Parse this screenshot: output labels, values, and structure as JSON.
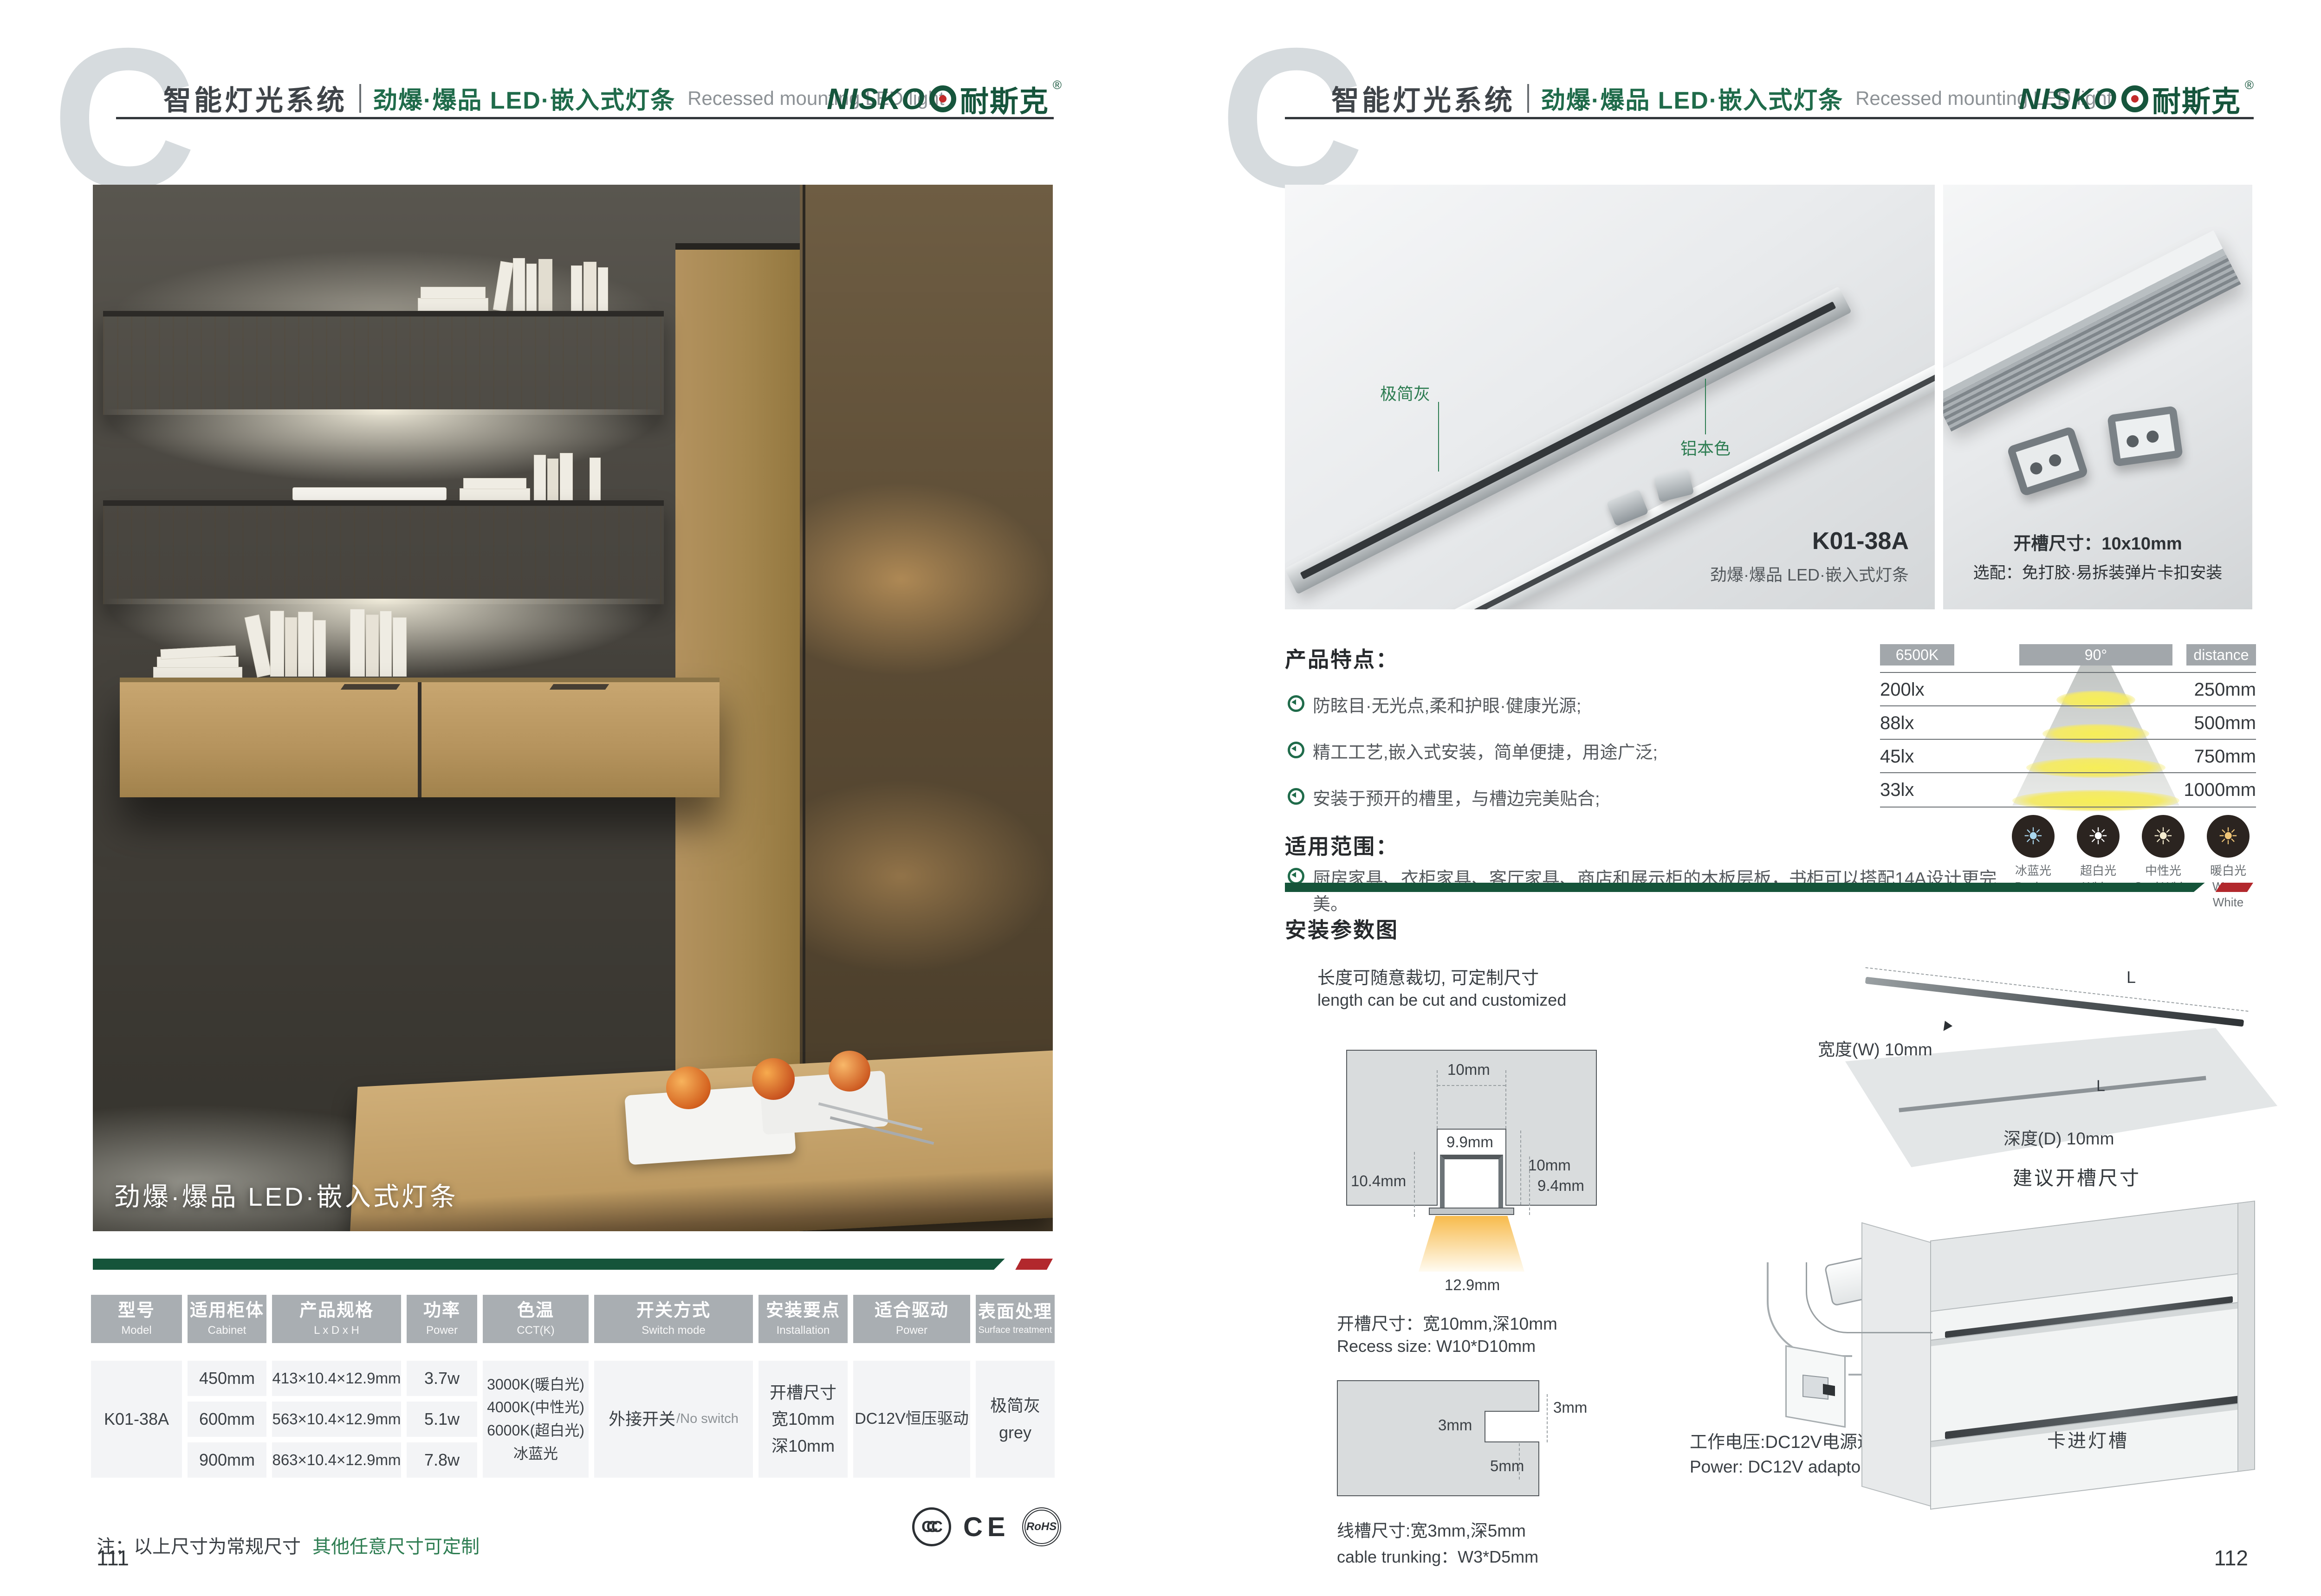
{
  "header": {
    "watermark": "C",
    "title_cn": "智能灯光系统",
    "subtitle_cn": "劲爆·爆品 LED·嵌入式灯条",
    "subtitle_en": "Recessed mounting LED light",
    "brand_en": "NISKO",
    "brand_cn": "耐斯克",
    "registered": "®"
  },
  "left_page": {
    "photo_caption": "劲爆·爆品 LED·嵌入式灯条",
    "table": {
      "columns": [
        {
          "cn": "型号",
          "en": "Model"
        },
        {
          "cn": "适用柜体",
          "en": "Cabinet"
        },
        {
          "cn": "产品规格",
          "en": "L x D x H"
        },
        {
          "cn": "功率",
          "en": "Power"
        },
        {
          "cn": "色温",
          "en": "CCT(K)"
        },
        {
          "cn": "开关方式",
          "en": "Switch mode"
        },
        {
          "cn": "安装要点",
          "en": "Installation"
        },
        {
          "cn": "适合驱动",
          "en": "Power"
        },
        {
          "cn": "表面处理",
          "en": "Surface treatment"
        }
      ],
      "model": "K01-38A",
      "rows": [
        {
          "cabinet": "450mm",
          "spec": "413×10.4×12.9mm",
          "power": "3.7w"
        },
        {
          "cabinet": "600mm",
          "spec": "563×10.4×12.9mm",
          "power": "5.1w"
        },
        {
          "cabinet": "900mm",
          "spec": "863×10.4×12.9mm",
          "power": "7.8w"
        }
      ],
      "cct_lines": [
        "3000K(暖白光)",
        "4000K(中性光)",
        "6000K(超白光)",
        "冰蓝光"
      ],
      "switch_cn": "外接开关",
      "switch_en": "/No switch",
      "install_lines": [
        "开槽尺寸",
        "宽10mm",
        "深10mm"
      ],
      "driver": "DC12V恒压驱动",
      "surface_cn": "极简灰",
      "surface_en": "grey"
    },
    "note_black": "注：以上尺寸为常规尺寸",
    "note_green": "其他任意尺寸可定制",
    "certs": [
      "CCC",
      "CE",
      "RoHS"
    ],
    "page_number": "111"
  },
  "right_page": {
    "photo_main": {
      "label_gray": "极简灰",
      "label_aluminum": "铝本色",
      "model": "K01-38A",
      "model_sub": "劲爆·爆品 LED·嵌入式灯条"
    },
    "photo_detail": {
      "line1": "开槽尺寸：10x10mm",
      "line2": "选配：免打胶·易拆装弹片卡扣安装"
    },
    "features": {
      "title": "产品特点：",
      "items": [
        "防眩目·无光点,柔和护眼·健康光源;",
        "精工工艺,嵌入式安装，简单便捷，用途广泛;",
        "安装于预开的槽里，与槽边完美贴合;"
      ]
    },
    "scope": {
      "title": "适用范围：",
      "items": [
        "厨房家具、衣柜家具、客厅家具、商店和展示柜的木板层板，书柜可以搭配14A设计更完美。"
      ]
    },
    "lux_chart": {
      "cct_badge": "6500K",
      "angle_badge": "90°",
      "distance_badge": "distance",
      "rows": [
        {
          "lux": "200lx",
          "distance": "250mm"
        },
        {
          "lux": "88lx",
          "distance": "500mm"
        },
        {
          "lux": "45lx",
          "distance": "750mm"
        },
        {
          "lux": "33lx",
          "distance": "1000mm"
        }
      ]
    },
    "light_modes": [
      {
        "cn": "冰蓝光",
        "en": "Basket"
      },
      {
        "cn": "超白光",
        "en": "White"
      },
      {
        "cn": "中性光",
        "en": "Cool White"
      },
      {
        "cn": "暖白光",
        "en": "Warm White"
      }
    ],
    "install": {
      "title": "安装参数图",
      "cut_cn": "长度可随意裁切, 可定制尺寸",
      "cut_en": "length can be cut and customized",
      "dims": {
        "slot_width": "10mm",
        "slot_depth": "10mm",
        "inner_width": "9.9mm",
        "left_height": "10.4mm",
        "right_height": "9.4mm",
        "flange_width": "12.9mm"
      },
      "recess_cn": "开槽尺寸：宽10mm,深10mm",
      "recess_en": "Recess size: W10*D10mm",
      "trunk_dims": {
        "edge": "3mm",
        "width": "3mm",
        "depth": "5mm"
      },
      "trunk_cn": "线槽尺寸:宽3mm,深5mm",
      "trunk_en": "cable trunking：W3*D5mm",
      "board": {
        "length_top": "L",
        "length_board": "L",
        "width_label": "宽度(W) 10mm",
        "depth_label": "深度(D) 10mm",
        "caption": "建议开槽尺寸"
      },
      "power_cn": "工作电压:DC12V电源适配器",
      "power_en": "Power: DC12V adaptor",
      "cabinet_label": "卡进灯槽"
    },
    "page_number": "112"
  },
  "colors": {
    "brand_green": "#16553c",
    "accent_green": "#2e7d52",
    "bar_green": "#15543a",
    "accent_red": "#b2282d",
    "table_header_gray": "#a9aeb2",
    "cell_gray": "#f3f4f6",
    "ink": "#3b4045",
    "light_ice_blue": "#a9d6ee",
    "light_white": "#ffffff",
    "light_cool_white": "#f5ecd0",
    "light_warm_white": "#f0c677"
  },
  "chart_data": {
    "type": "table",
    "title": "6500K beam illuminance vs distance",
    "cct": "6500K",
    "beam_angle": "90°",
    "columns": [
      "illuminance",
      "distance"
    ],
    "rows": [
      [
        "200lx",
        "250mm"
      ],
      [
        "88lx",
        "500mm"
      ],
      [
        "45lx",
        "750mm"
      ],
      [
        "33lx",
        "1000mm"
      ]
    ]
  }
}
